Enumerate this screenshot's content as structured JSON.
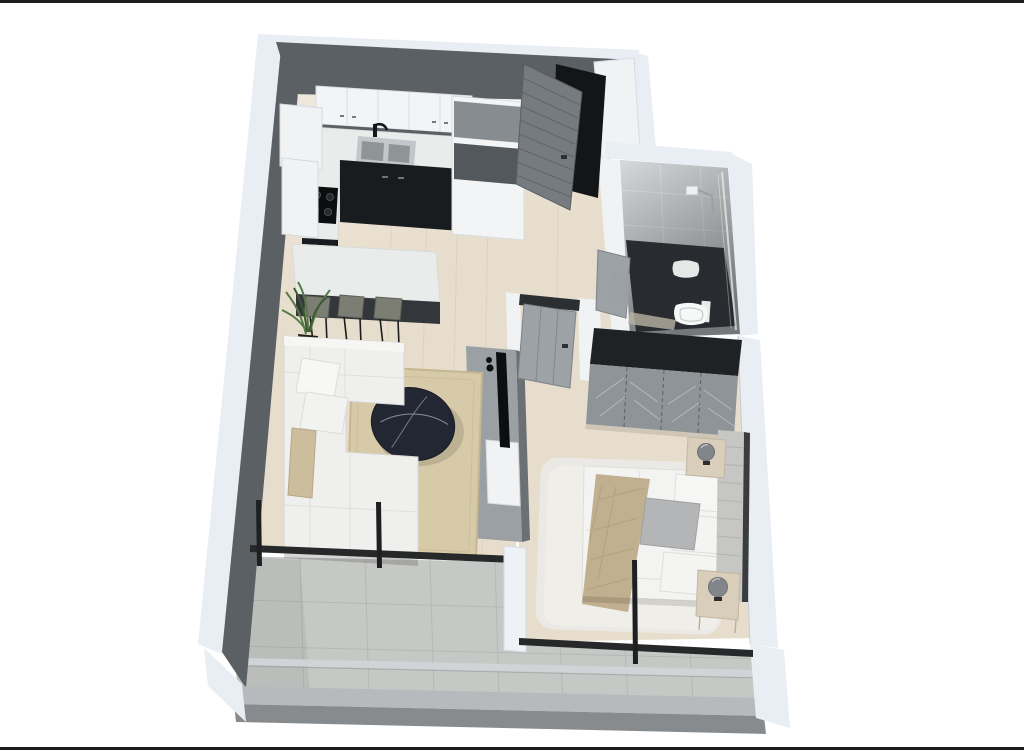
{
  "page": {
    "background": "#ffffff",
    "frame_line_color": "#1c1c1c"
  },
  "floorplan": {
    "view": "3d-isometric-one-bedroom-apartment-floor-plan-render",
    "rooms": [
      {
        "name": "kitchen",
        "features": [
          "upper-cabinets",
          "countertop",
          "double-sink",
          "gas-cooktop",
          "tall-cabinet-column",
          "island-counter",
          "bar-stools",
          "plant"
        ]
      },
      {
        "name": "living-room",
        "features": [
          "l-shaped-sofa",
          "throw-pillows",
          "oval-coffee-table",
          "area-rug",
          "tv-media-unit"
        ]
      },
      {
        "name": "entry",
        "features": [
          "open-slatted-front-door",
          "closet-panel"
        ]
      },
      {
        "name": "bathroom",
        "features": [
          "walk-in-shower",
          "shower-head",
          "glass-panel",
          "toilet",
          "open-door",
          "vanity"
        ]
      },
      {
        "name": "bedroom",
        "features": [
          "double-bed",
          "upholstered-headboard",
          "throw-blanket",
          "pillows",
          "fluffy-rug",
          "wardrobe",
          "nightstands",
          "sphere-lamps",
          "open-slatted-door"
        ]
      },
      {
        "name": "balcony",
        "features": [
          "stone-tile-floor",
          "glass-railing-bar",
          "parapet-wall",
          "window-mullions"
        ]
      }
    ]
  },
  "colors": {
    "frame": "#1c1c1c",
    "wallOuter": "#e9edf4",
    "wallDark": "#5b6064",
    "woodFloor": "#e7ddcc",
    "balconyTile": "#c6c8c5",
    "balconyGrout": "#b2b4b1",
    "counter": "#eaeceb",
    "cabinetWhite": "#f3f4f6",
    "cabinetDark": "#191c1f",
    "backsplash": "#5a5f63",
    "sinkSteel": "#c3c7c9",
    "sinkBasin": "#8f9497",
    "tallGray": "#878c90",
    "tallDark": "#53585c",
    "doorGray": "#767b7f",
    "doorSlat": "#5f6367",
    "doorwayDark": "#141517",
    "jambWhite": "#f0f2f4",
    "bathTile": "#d5d9db",
    "bathDark": "#282b2f",
    "vanityGray": "#9aa0a4",
    "fixtureWhite": "#f6f7f7",
    "wardrobeTop": "#1f2225",
    "wardrobeFront": "#8f9498",
    "wardrobeStripe": "#c9ced2",
    "bedWhite": "#f3f3f2",
    "headboard": "#c6c7c5",
    "throwTan": "#c1b08f",
    "bedRug": "#ebe9e5",
    "pillowGray": "#b4b5b6",
    "sofaWhite": "#eff0ee",
    "pillowTan": "#ccbd9d",
    "rugBeige": "#d7caa8",
    "rugBorder": "#c6b790",
    "tableDark": "#232733",
    "tableVein": "#9aa0b0",
    "stoolGray": "#7c7e74",
    "stoolLeg": "#1c1c1c",
    "plantGreen": "#567a47",
    "plantDeep": "#3c5a31",
    "potDark": "#20221f",
    "tvBlack": "#0d0e10",
    "unitGray": "#9aa0a3",
    "unitDark": "#6b7074",
    "railing": "#d0d4d7",
    "parapetTop": "#b6babd",
    "parapetUnder": "#878b8e",
    "windowFrame": "#26282a",
    "pillarWhite": "#eef1f5",
    "nightstand": "#d9ceba",
    "lampGray": "#82868a"
  }
}
